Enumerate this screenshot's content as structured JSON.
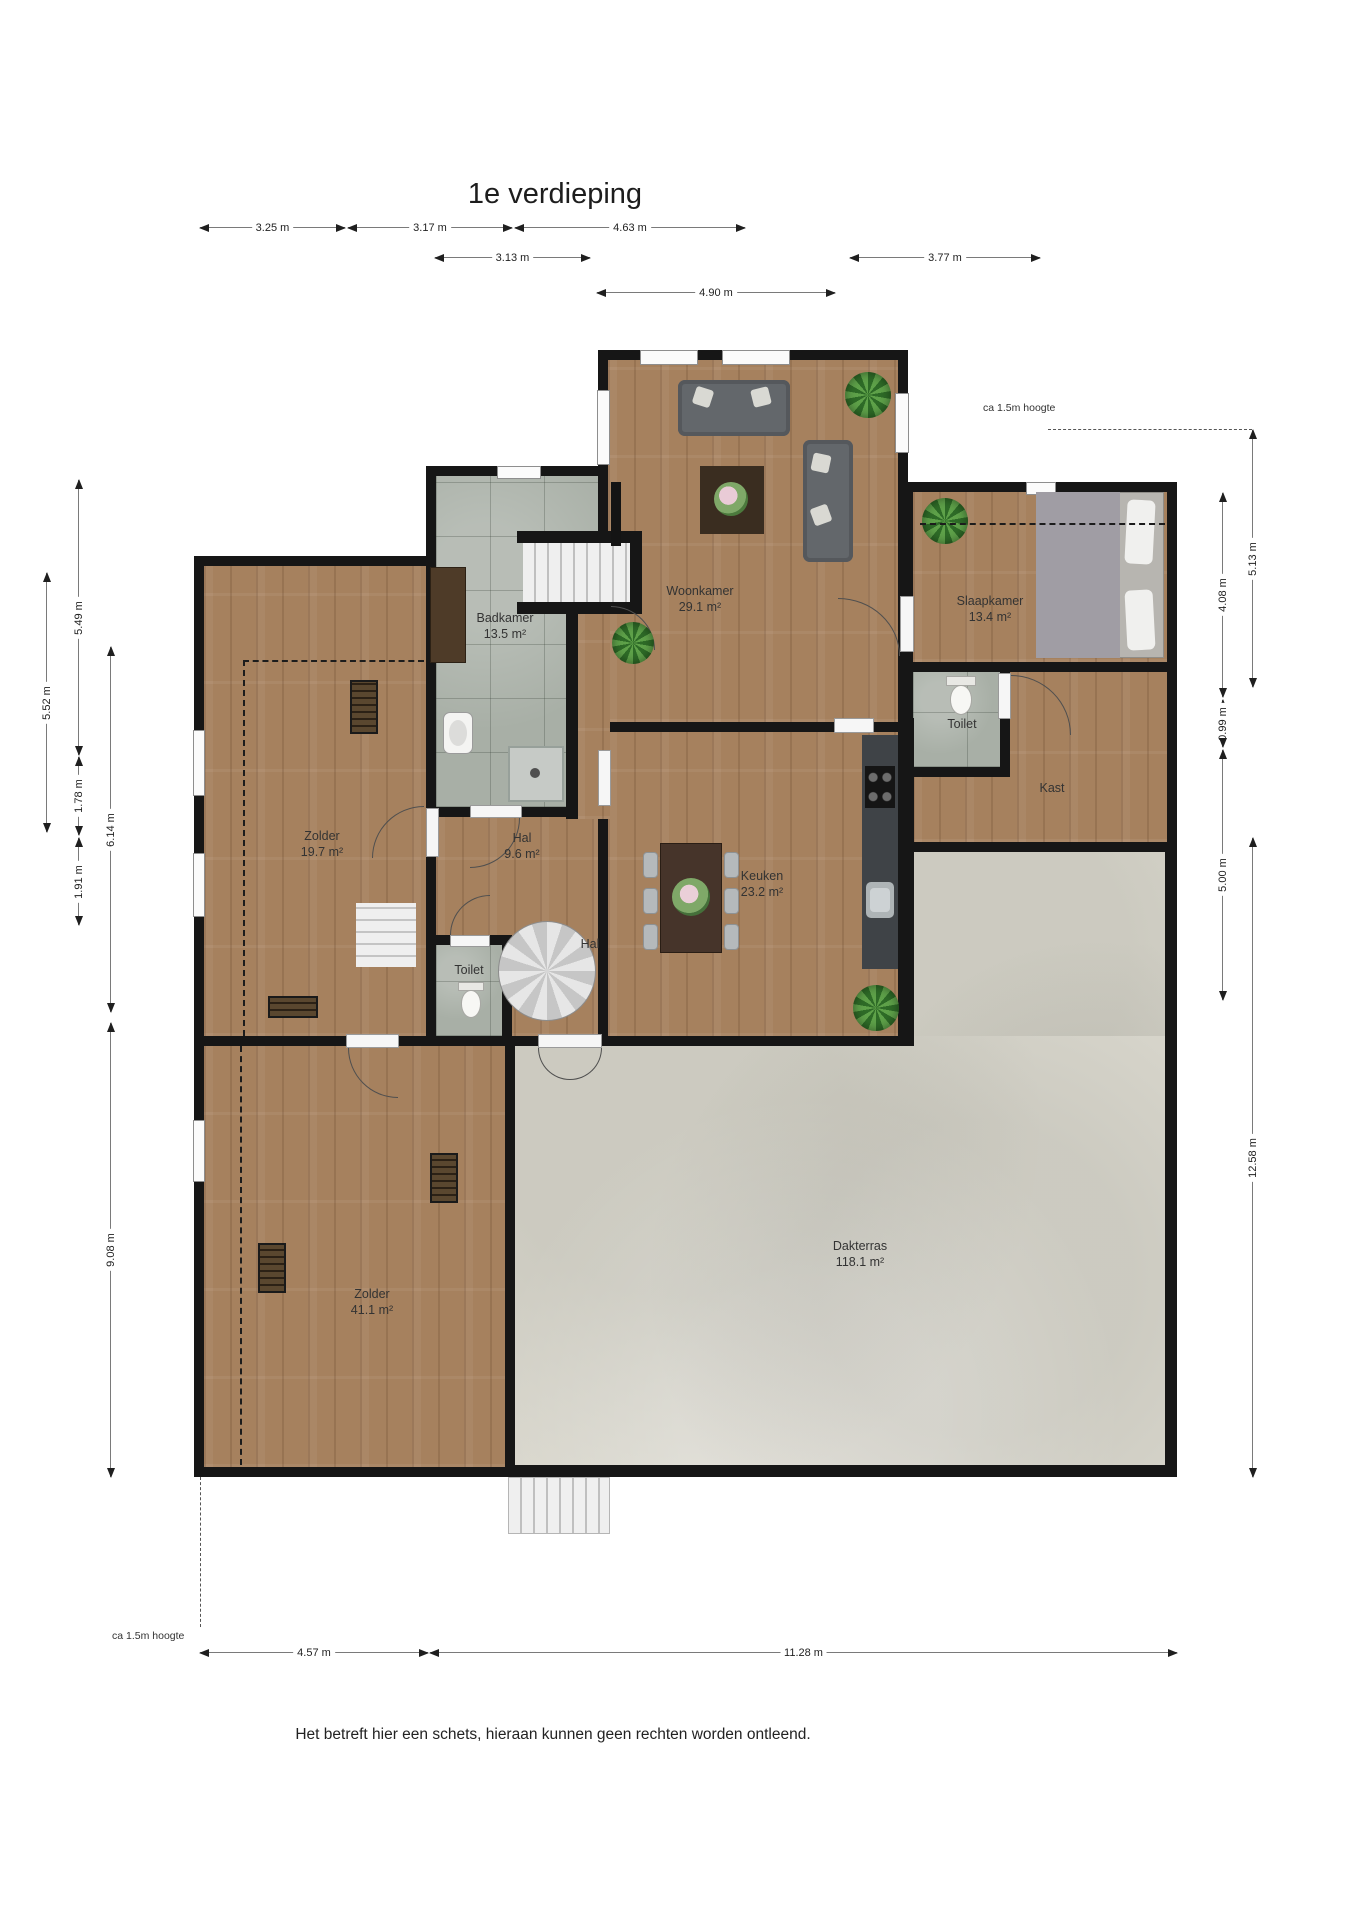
{
  "title": "1e verdieping",
  "footer": "Het betreft hier een schets, hieraan kunnen geen rechten worden ontleend.",
  "annotations": {
    "height_note": "ca 1.5m hoogte"
  },
  "rooms": {
    "woonkamer": {
      "name": "Woonkamer",
      "area": "29.1 m²"
    },
    "badkamer": {
      "name": "Badkamer",
      "area": "13.5 m²"
    },
    "slaapkamer": {
      "name": "Slaapkamer",
      "area": "13.4 m²"
    },
    "toilet_boven": {
      "name": "Toilet"
    },
    "kast": {
      "name": "Kast"
    },
    "zolder_klein": {
      "name": "Zolder",
      "area": "19.7 m²"
    },
    "hal_groot": {
      "name": "Hal",
      "area": "9.6 m²"
    },
    "hal_klein": {
      "name": "Hal"
    },
    "toilet_beneden": {
      "name": "Toilet"
    },
    "keuken": {
      "name": "Keuken",
      "area": "23.2 m²"
    },
    "dakterras": {
      "name": "Dakterras",
      "area": "118.1 m²"
    },
    "zolder_groot": {
      "name": "Zolder",
      "area": "41.1 m²"
    }
  },
  "dimensions": {
    "top": [
      "3.25 m",
      "3.17 m",
      "4.63 m",
      "3.13 m",
      "3.77 m",
      "4.90 m"
    ],
    "left": [
      "5.49 m",
      "5.52 m",
      "1.78 m",
      "1.91 m",
      "6.14 m",
      "9.08 m"
    ],
    "right": [
      "5.13 m",
      "4.08 m",
      "0.99 m",
      "5.00 m",
      "12.58 m"
    ],
    "bottom": [
      "4.57 m",
      "11.28 m"
    ]
  },
  "colors": {
    "wall": "#161616",
    "wood_floor": "#a6815e",
    "tile_floor": "#a8afa6",
    "terrace_floor": "#d8d6cc",
    "plant_green": "#4f9a3e",
    "sofa_grey": "#63676b"
  }
}
